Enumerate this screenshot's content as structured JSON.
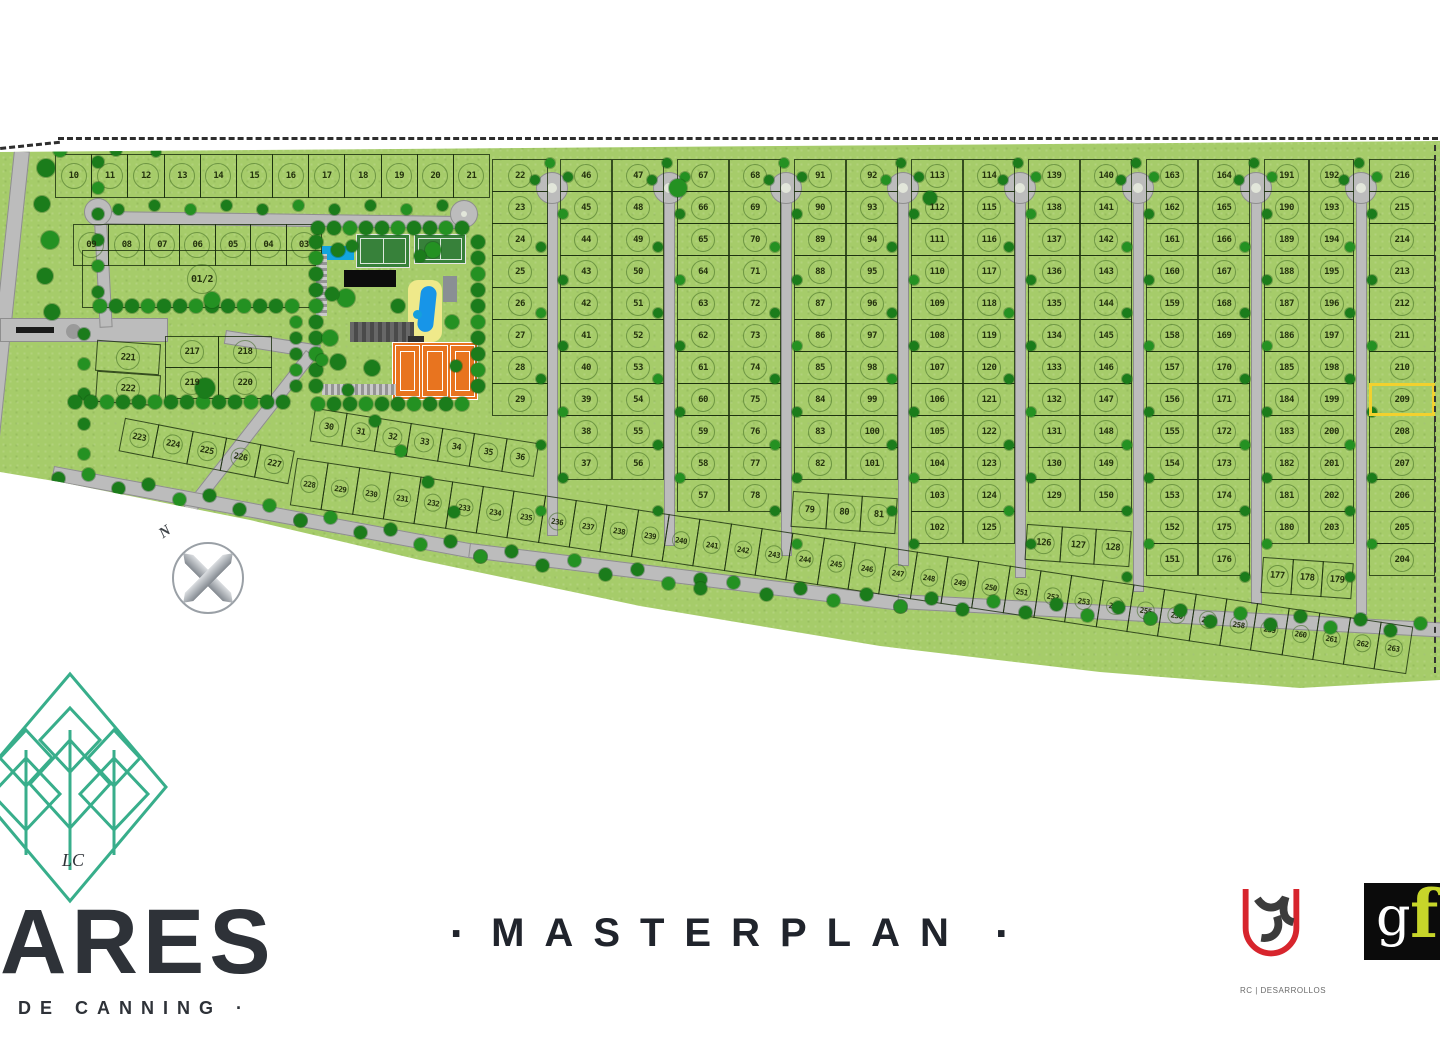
{
  "page": {
    "masterplan_title": "MASTERPLAN",
    "masterplan_dot": "·"
  },
  "brand": {
    "name": "ARES",
    "subtitle": "DE CANNING ·",
    "monogram": "LC"
  },
  "partners": {
    "rc_caption": "RC | DESARROLLOS",
    "gf_g": "g",
    "gf_f": "f"
  },
  "compass": {
    "north_label": "N"
  },
  "colors": {
    "site_green": "#a6cc6a",
    "tree_green": "#1b7c1b",
    "road_gray": "#bcbcbc",
    "tennis_orange": "#e8741f",
    "pool_blue": "#1795e8",
    "highlight_yellow": "#f2d12e",
    "brand_teal": "#38ae8b",
    "gf_chartreuse": "#c7d52a",
    "rc_red": "#d7252d"
  },
  "map": {
    "highlight_lot": "209",
    "top_row": [
      "10",
      "11",
      "12",
      "13",
      "14",
      "15",
      "16",
      "17",
      "18",
      "19",
      "20",
      "21"
    ],
    "row_left": [
      "09",
      "08",
      "07",
      "06",
      "05",
      "04",
      "03"
    ],
    "big_lot": "01/2",
    "grid_217_top": [
      "217",
      "218"
    ],
    "grid_217_bottom": [
      "219",
      "220"
    ],
    "col_221": [
      "221",
      "222"
    ],
    "diag_223": [
      "223",
      "224",
      "225",
      "226",
      "227"
    ],
    "diag_30": [
      "30",
      "31",
      "32",
      "33",
      "34",
      "35",
      "36"
    ],
    "strip_bottom": [
      "228",
      "229",
      "230",
      "231",
      "232",
      "233",
      "234",
      "235",
      "236",
      "237",
      "238",
      "239",
      "240",
      "241",
      "242",
      "243",
      "244",
      "245",
      "246",
      "247",
      "248",
      "249",
      "250",
      "251",
      "252",
      "253",
      "254",
      "255",
      "256",
      "257",
      "258",
      "259",
      "260",
      "261",
      "262",
      "263"
    ],
    "blocks": [
      {
        "cols": [
          [
            "22",
            "23",
            "24",
            "25",
            "26",
            "27",
            "28",
            "29"
          ]
        ]
      },
      {
        "cols": [
          [
            "46",
            "45",
            "44",
            "43",
            "42",
            "41",
            "40",
            "39",
            "38",
            "37"
          ],
          [
            "47",
            "48",
            "49",
            "50",
            "51",
            "52",
            "53",
            "54",
            "55",
            "56"
          ]
        ]
      },
      {
        "cols": [
          [
            "67",
            "66",
            "65",
            "64",
            "63",
            "62",
            "61",
            "60",
            "59",
            "58",
            "57"
          ],
          [
            "68",
            "69",
            "70",
            "71",
            "72",
            "73",
            "74",
            "75",
            "76",
            "77",
            "78"
          ]
        ]
      },
      {
        "cols": [
          [
            "91",
            "90",
            "89",
            "88",
            "87",
            "86",
            "85",
            "84",
            "83",
            "82"
          ],
          [
            "92",
            "93",
            "94",
            "95",
            "96",
            "97",
            "98",
            "99",
            "100",
            "101"
          ]
        ],
        "bottom": [
          "79",
          "80",
          "81"
        ]
      },
      {
        "cols": [
          [
            "113",
            "112",
            "111",
            "110",
            "109",
            "108",
            "107",
            "106",
            "105",
            "104",
            "103",
            "102"
          ],
          [
            "114",
            "115",
            "116",
            "117",
            "118",
            "119",
            "120",
            "121",
            "122",
            "123",
            "124",
            "125"
          ]
        ]
      },
      {
        "cols": [
          [
            "139",
            "138",
            "137",
            "136",
            "135",
            "134",
            "133",
            "132",
            "131",
            "130",
            "129"
          ],
          [
            "140",
            "141",
            "142",
            "143",
            "144",
            "145",
            "146",
            "147",
            "148",
            "149",
            "150"
          ]
        ],
        "bottom": [
          "126",
          "127",
          "128"
        ]
      },
      {
        "cols": [
          [
            "163",
            "162",
            "161",
            "160",
            "159",
            "158",
            "157",
            "156",
            "155",
            "154",
            "153",
            "152",
            "151"
          ],
          [
            "164",
            "165",
            "166",
            "167",
            "168",
            "169",
            "170",
            "171",
            "172",
            "173",
            "174",
            "175",
            "176"
          ]
        ]
      },
      {
        "cols": [
          [
            "191",
            "190",
            "189",
            "188",
            "187",
            "186",
            "185",
            "184",
            "183",
            "182",
            "181",
            "180"
          ],
          [
            "192",
            "193",
            "194",
            "195",
            "196",
            "197",
            "198",
            "199",
            "200",
            "201",
            "202",
            "203"
          ]
        ],
        "bottom": [
          "177",
          "178",
          "179"
        ]
      },
      {
        "cols": [
          [
            "216",
            "215",
            "214",
            "213",
            "212",
            "211",
            "210",
            "209",
            "208",
            "207",
            "206",
            "205",
            "204"
          ]
        ]
      }
    ]
  }
}
